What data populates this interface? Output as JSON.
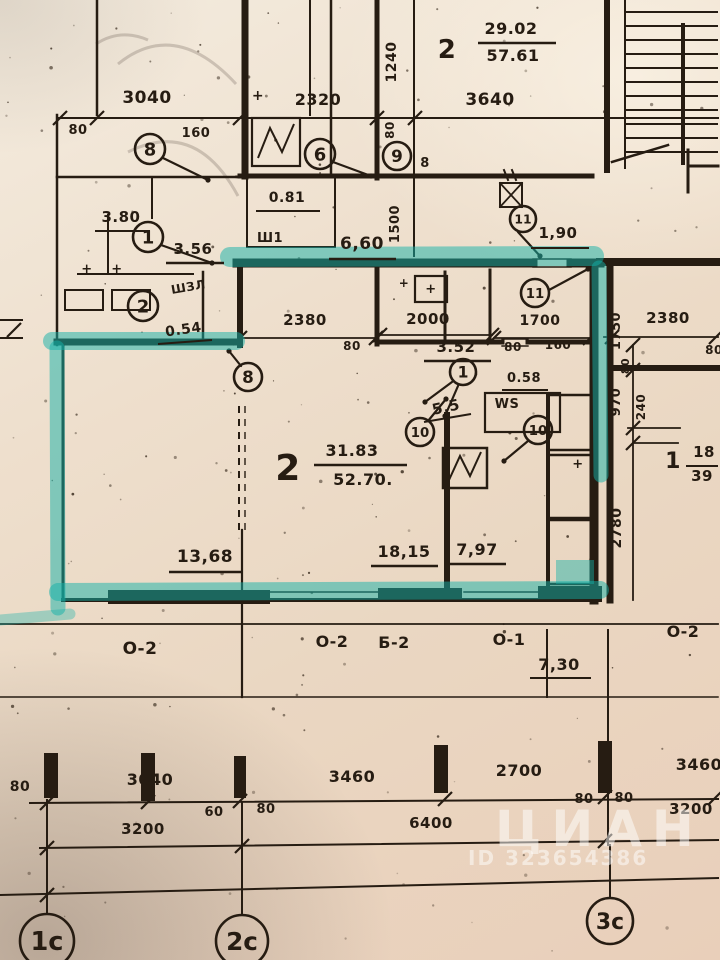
{
  "palette": {
    "ink": "#261c12",
    "teal": "#14b2a9",
    "paper": "#eedfcd",
    "white": "#ffffff"
  },
  "watermark": {
    "brand": "ЦИАН",
    "id_text": "ID 323654386"
  },
  "plan": {
    "labels": [
      [
        "29.02",
        511,
        34,
        16,
        0
      ],
      [
        "57.61",
        513,
        61,
        16,
        0
      ],
      [
        "2",
        447,
        58,
        26,
        0
      ],
      [
        "3640",
        490,
        105,
        17,
        0
      ],
      [
        "3040",
        147,
        103,
        17,
        0
      ],
      [
        "2320",
        318,
        105,
        16,
        0
      ],
      [
        "1240",
        396,
        62,
        14,
        -90
      ],
      [
        "80",
        78,
        134,
        13,
        0
      ],
      [
        "160",
        196,
        137,
        13,
        0
      ],
      [
        "80",
        394,
        130,
        12,
        -90
      ],
      [
        "8",
        425,
        167,
        13,
        0
      ],
      [
        "0.81",
        287,
        202,
        14,
        0
      ],
      [
        "Ш1",
        270,
        242,
        13,
        0
      ],
      [
        "3.80",
        121,
        222,
        15,
        0
      ],
      [
        "3.56",
        193,
        254,
        15,
        0
      ],
      [
        "ШЗЛ",
        189,
        291,
        12,
        -10
      ],
      [
        "0.54",
        184,
        334,
        14,
        -8
      ],
      [
        "+",
        258,
        100,
        14,
        0
      ],
      [
        "+",
        87,
        273,
        13,
        0
      ],
      [
        "+",
        117,
        273,
        13,
        0
      ],
      [
        "6,60",
        362,
        249,
        17,
        0
      ],
      [
        "1500",
        399,
        224,
        13,
        -90
      ],
      [
        "1,90",
        558,
        238,
        15,
        0
      ],
      [
        "2380",
        305,
        325,
        15,
        0
      ],
      [
        "80",
        352,
        350,
        12,
        0
      ],
      [
        "2000",
        428,
        324,
        15,
        0
      ],
      [
        "3.52",
        456,
        352,
        15,
        0
      ],
      [
        "1700",
        540,
        325,
        14,
        0
      ],
      [
        "80",
        513,
        351,
        12,
        0
      ],
      [
        "160",
        558,
        349,
        12,
        0
      ],
      [
        "+",
        404,
        287,
        12,
        0
      ],
      [
        "+",
        431,
        293,
        13,
        0
      ],
      [
        "0.58",
        524,
        382,
        13,
        0
      ],
      [
        "WS",
        507,
        408,
        13,
        0
      ],
      [
        "5,5",
        447,
        412,
        15,
        -12
      ],
      [
        "31.83",
        352,
        456,
        16,
        0
      ],
      [
        "52.70.",
        363,
        485,
        16,
        0
      ],
      [
        "2",
        288,
        480,
        36,
        0
      ],
      [
        "13,68",
        205,
        562,
        17,
        0
      ],
      [
        "18,15",
        404,
        557,
        16,
        0
      ],
      [
        "7,97",
        477,
        555,
        16,
        0
      ],
      [
        "2380",
        668,
        323,
        15,
        0
      ],
      [
        "80",
        714,
        354,
        12,
        0
      ],
      [
        "1750",
        620,
        331,
        13,
        -90
      ],
      [
        "80",
        629,
        366,
        11,
        -90
      ],
      [
        "970",
        620,
        402,
        13,
        -90
      ],
      [
        "240",
        645,
        407,
        12,
        -90
      ],
      [
        "2780",
        621,
        528,
        14,
        -90
      ],
      [
        "1",
        673,
        468,
        22,
        0
      ],
      [
        "18",
        704,
        457,
        15,
        0
      ],
      [
        "39",
        702,
        481,
        15,
        0
      ],
      [
        "+",
        578,
        468,
        13,
        0
      ],
      [
        "О-2",
        140,
        654,
        17,
        0
      ],
      [
        "О-2",
        332,
        647,
        16,
        0
      ],
      [
        "Б-2",
        394,
        648,
        16,
        0
      ],
      [
        "О-1",
        509,
        645,
        16,
        0
      ],
      [
        "О-2",
        683,
        637,
        16,
        0
      ],
      [
        "7,30",
        559,
        670,
        16,
        0
      ],
      [
        "80",
        20,
        791,
        14,
        0
      ],
      [
        "3040",
        150,
        785,
        16,
        0
      ],
      [
        "60",
        214,
        816,
        13,
        0
      ],
      [
        "80",
        266,
        813,
        13,
        0
      ],
      [
        "3460",
        352,
        782,
        16,
        0
      ],
      [
        "2700",
        519,
        776,
        16,
        0
      ],
      [
        "80",
        584,
        803,
        13,
        0
      ],
      [
        "80",
        624,
        802,
        13,
        0
      ],
      [
        "3460",
        699,
        770,
        16,
        0
      ],
      [
        "3200",
        143,
        834,
        15,
        0
      ],
      [
        "6400",
        431,
        828,
        15,
        0
      ],
      [
        "3200",
        691,
        814,
        15,
        0
      ]
    ],
    "underlines": [
      [
        478,
        43,
        556,
        43,
        2.5
      ],
      [
        256,
        211,
        320,
        211,
        2
      ],
      [
        95,
        231,
        150,
        231,
        2
      ],
      [
        166,
        263,
        224,
        263,
        2.5
      ],
      [
        158,
        344,
        212,
        340,
        2
      ],
      [
        329,
        259,
        396,
        259,
        2.5
      ],
      [
        531,
        248,
        589,
        248,
        2
      ],
      [
        424,
        361,
        491,
        361,
        2.5
      ],
      [
        502,
        390,
        548,
        390,
        2
      ],
      [
        424,
        422,
        471,
        414,
        2
      ],
      [
        314,
        465,
        407,
        465,
        2.5
      ],
      [
        169,
        572,
        243,
        572,
        2.5
      ],
      [
        371,
        566,
        438,
        566,
        2.5
      ],
      [
        447,
        564,
        506,
        564,
        2.5
      ],
      [
        686,
        466,
        718,
        466,
        2
      ],
      [
        530,
        678,
        591,
        678,
        2
      ]
    ],
    "ink_lines": [
      [
        57,
        118,
        718,
        118,
        2
      ],
      [
        0,
        320,
        22,
        320,
        2
      ],
      [
        0,
        338,
        22,
        338,
        2
      ],
      [
        240,
        338,
        376,
        338,
        1.8
      ],
      [
        380,
        335,
        492,
        335,
        1.8
      ],
      [
        494,
        338,
        590,
        338,
        1.8
      ],
      [
        604,
        337,
        718,
        337,
        1.8
      ],
      [
        633,
        345,
        633,
        600,
        1.8
      ],
      [
        628,
        370,
        680,
        370,
        1.8
      ],
      [
        628,
        428,
        680,
        428,
        1.8
      ],
      [
        633,
        443,
        678,
        443,
        1.8
      ],
      [
        0,
        624,
        718,
        624,
        1.8
      ],
      [
        0,
        697,
        718,
        697,
        1.5
      ],
      [
        30,
        803,
        718,
        799,
        2
      ],
      [
        40,
        848,
        718,
        840,
        2
      ],
      [
        0,
        895,
        718,
        878,
        2
      ],
      [
        47,
        800,
        47,
        914,
        2
      ],
      [
        242,
        802,
        242,
        914,
        2
      ],
      [
        610,
        845,
        610,
        897,
        2
      ],
      [
        547,
        630,
        547,
        697,
        2
      ],
      [
        242,
        530,
        242,
        697,
        2.2
      ],
      [
        608,
        630,
        608,
        845,
        2
      ],
      [
        270,
        592,
        380,
        592,
        1.5
      ],
      [
        270,
        599,
        380,
        599,
        1.5
      ],
      [
        464,
        592,
        540,
        592,
        1.5
      ],
      [
        464,
        599,
        540,
        599,
        1.5
      ],
      [
        533,
        259,
        571,
        259,
        1.5
      ],
      [
        533,
        267,
        571,
        267,
        1.5
      ],
      [
        502,
        339,
        528,
        339,
        1.4
      ],
      [
        502,
        346,
        528,
        346,
        1.4
      ],
      [
        97,
        0,
        97,
        115,
        2.5
      ],
      [
        57,
        115,
        57,
        345,
        2.5
      ],
      [
        245,
        0,
        245,
        176,
        7
      ],
      [
        310,
        0,
        310,
        115,
        2
      ],
      [
        331,
        0,
        331,
        176,
        2.5
      ],
      [
        377,
        0,
        377,
        178,
        5
      ],
      [
        414,
        0,
        414,
        256,
        2
      ],
      [
        240,
        176,
        592,
        176,
        5
      ],
      [
        607,
        0,
        607,
        170,
        6
      ],
      [
        625,
        0,
        625,
        168,
        2
      ],
      [
        683,
        25,
        683,
        163,
        4
      ],
      [
        688,
        150,
        688,
        192,
        3
      ],
      [
        688,
        166,
        718,
        166,
        3
      ],
      [
        237,
        263,
        533,
        263,
        9
      ],
      [
        571,
        263,
        600,
        263,
        9
      ],
      [
        240,
        268,
        240,
        345,
        6
      ],
      [
        57,
        342,
        237,
        342,
        7
      ],
      [
        63,
        345,
        63,
        600,
        3
      ],
      [
        63,
        600,
        600,
        600,
        4
      ],
      [
        594,
        266,
        594,
        600,
        9
      ],
      [
        610,
        266,
        610,
        600,
        7
      ],
      [
        600,
        262,
        718,
        262,
        8
      ],
      [
        610,
        368,
        718,
        368,
        6
      ],
      [
        377,
        270,
        377,
        344,
        5
      ],
      [
        445,
        272,
        445,
        342,
        3
      ],
      [
        490,
        270,
        490,
        342,
        3
      ],
      [
        377,
        342,
        502,
        342,
        5
      ],
      [
        528,
        342,
        594,
        342,
        5
      ],
      [
        447,
        415,
        447,
        594,
        6
      ],
      [
        548,
        395,
        548,
        592,
        4
      ],
      [
        57,
        177,
        237,
        177,
        2.5
      ],
      [
        108,
        215,
        108,
        274,
        2
      ],
      [
        78,
        274,
        193,
        274,
        2
      ],
      [
        203,
        272,
        203,
        340,
        2.5
      ],
      [
        152,
        177,
        152,
        218,
        2
      ],
      [
        247,
        177,
        247,
        247,
        2
      ],
      [
        335,
        177,
        335,
        247,
        2
      ],
      [
        247,
        247,
        335,
        247,
        2
      ],
      [
        500,
        183,
        522,
        207,
        1.8
      ],
      [
        522,
        183,
        500,
        207,
        1.8
      ],
      [
        508,
        180,
        504,
        170,
        2
      ],
      [
        516,
        180,
        512,
        170,
        2
      ],
      [
        612,
        162,
        668,
        145,
        2.5
      ]
    ],
    "leaders": [
      [
        163,
        158,
        208,
        180
      ],
      [
        333,
        162,
        371,
        176
      ],
      [
        161,
        245,
        212,
        263
      ],
      [
        518,
        232,
        540,
        256
      ],
      [
        549,
        290,
        588,
        269
      ],
      [
        452,
        382,
        425,
        402
      ],
      [
        458,
        386,
        445,
        416
      ],
      [
        428,
        421,
        446,
        399
      ],
      [
        528,
        441,
        504,
        461
      ],
      [
        241,
        366,
        229,
        351
      ]
    ],
    "stroke_rects": [
      [
        252,
        118,
        48,
        48,
        2.2
      ],
      [
        443,
        448,
        44,
        40,
        2.5
      ],
      [
        500,
        183,
        22,
        24,
        2
      ],
      [
        415,
        276,
        32,
        26,
        2.2
      ],
      [
        65,
        290,
        38,
        20,
        2
      ],
      [
        112,
        290,
        38,
        20,
        2
      ],
      [
        548,
        395,
        46,
        55,
        2.5
      ],
      [
        548,
        455,
        46,
        63,
        2.5
      ],
      [
        548,
        520,
        46,
        64,
        2.5
      ],
      [
        485,
        393,
        75,
        39,
        2.2
      ]
    ],
    "fill_rects": [
      [
        108,
        590,
        162,
        14
      ],
      [
        378,
        588,
        84,
        14
      ],
      [
        538,
        586,
        64,
        12
      ],
      [
        44,
        753,
        14,
        45
      ],
      [
        141,
        753,
        14,
        48
      ],
      [
        434,
        745,
        14,
        48
      ],
      [
        598,
        741,
        14,
        52
      ],
      [
        234,
        756,
        12,
        42
      ]
    ],
    "marker_circles": [
      [
        "8",
        150,
        149,
        15
      ],
      [
        "6",
        320,
        154,
        15
      ],
      [
        "9",
        397,
        156,
        14
      ],
      [
        "1",
        148,
        237,
        15
      ],
      [
        "2",
        143,
        306,
        15
      ],
      [
        "11",
        523,
        219,
        13
      ],
      [
        "11",
        535,
        293,
        14
      ],
      [
        "8",
        248,
        377,
        14
      ],
      [
        "1",
        463,
        372,
        13
      ],
      [
        "10",
        420,
        432,
        14
      ],
      [
        "10",
        538,
        430,
        14
      ],
      [
        "1с",
        47,
        941,
        27
      ],
      [
        "2с",
        242,
        941,
        26
      ],
      [
        "3с",
        610,
        921,
        23
      ]
    ],
    "teal_strokes": [
      [
        230,
        257,
        594,
        256,
        20,
        0.5
      ],
      [
        599,
        268,
        601,
        475,
        15,
        0.5
      ],
      [
        52,
        341,
        236,
        341,
        18,
        0.5
      ],
      [
        57,
        348,
        58,
        608,
        15,
        0.5
      ],
      [
        58,
        592,
        600,
        590,
        18,
        0.5
      ],
      [
        0,
        620,
        70,
        614,
        11,
        0.35
      ]
    ],
    "teal_fills": [
      [
        556,
        560,
        38,
        24,
        0.45
      ]
    ],
    "ticks": [
      [
        60,
        118
      ],
      [
        97,
        118
      ],
      [
        240,
        118
      ],
      [
        377,
        118
      ],
      [
        415,
        118
      ],
      [
        240,
        338
      ],
      [
        376,
        338
      ],
      [
        380,
        335
      ],
      [
        492,
        335
      ],
      [
        494,
        338
      ],
      [
        590,
        338
      ],
      [
        612,
        337
      ],
      [
        716,
        337
      ],
      [
        633,
        345
      ],
      [
        633,
        370
      ],
      [
        633,
        428
      ],
      [
        633,
        443
      ],
      [
        47,
        803
      ],
      [
        148,
        802
      ],
      [
        240,
        801
      ],
      [
        445,
        799
      ],
      [
        605,
        797
      ],
      [
        716,
        797
      ],
      [
        47,
        848
      ],
      [
        242,
        846
      ],
      [
        605,
        841
      ],
      [
        47,
        895
      ],
      [
        14,
        330
      ]
    ],
    "stairs": {
      "x1": 625,
      "x2": 718,
      "y0": 12,
      "step": 14,
      "count": 11
    },
    "zigzags": [
      "M258,158 L270,128 L282,152 L294,124",
      "M449,480 L460,456 L470,476 L481,452"
    ],
    "dashed_lines": [
      [
        239,
        406,
        239,
        530,
        2
      ],
      [
        245,
        406,
        245,
        530,
        1.4
      ]
    ],
    "scribbles": [
      "M118,64 Q175,18 236,84",
      "M128,152 Q196,118 238,196",
      "M96,44 Q120,28 148,40"
    ],
    "dots": {
      "seed": 11,
      "count": 150,
      "count_low": 25
    }
  }
}
